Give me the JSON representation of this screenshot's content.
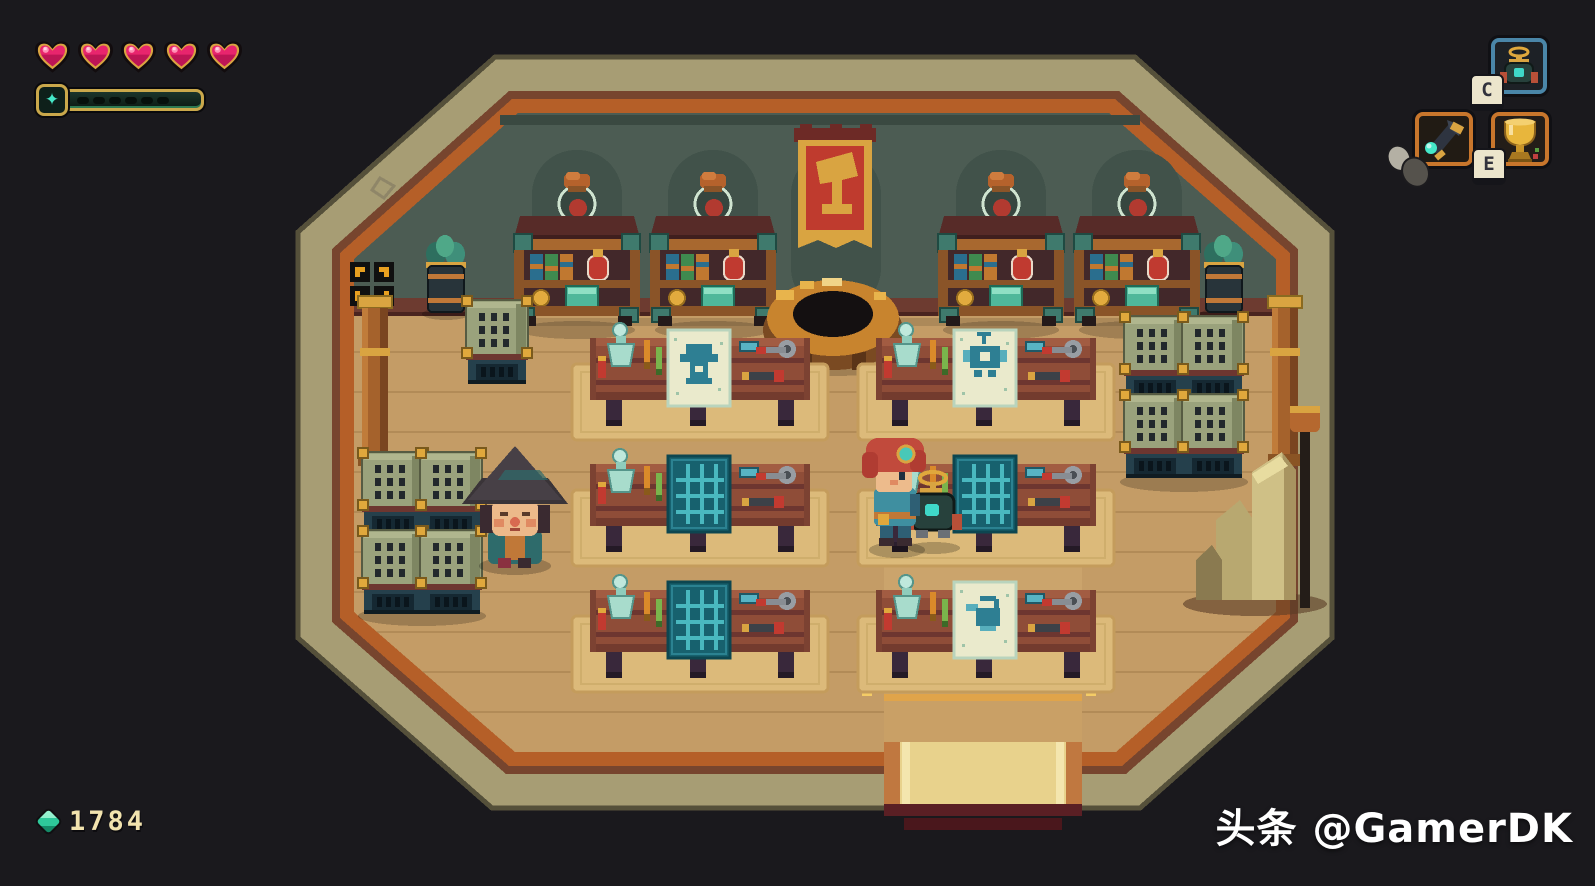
{
  "hud": {
    "hearts": {
      "count": 5,
      "filled": 5,
      "fill_color": "#e8256d",
      "border_color": "#d9a441",
      "outline_color": "#120c0e"
    },
    "energy": {
      "glyph": "✦",
      "segments": 6,
      "filled": 0,
      "frame_color": "#caa84b",
      "star_color": "#45e8c8"
    },
    "currency": {
      "amount": "1784",
      "gem_color": "#2ec89a",
      "text_color": "#f2e3ae"
    },
    "slots": {
      "gadget": {
        "item": "beacon-robot-gadget",
        "border_color": "#4a86a8",
        "keycap": "C"
      },
      "tool": {
        "item": "patcher-wrench-tool",
        "border_color": "#c8762c",
        "binding": "mouse"
      },
      "consumable": {
        "item": "gold-trophy",
        "border_color": "#c8762c",
        "keycap": "E"
      }
    }
  },
  "scene": {
    "location": "workshop-shop-interior",
    "banner_symbol": "gold hammer on red banner",
    "shelf_units": 4,
    "workbench_tables": 6,
    "blueprints": [
      "gadget-sketch",
      "robot-sketch",
      "empty-grid",
      "empty-grid",
      "empty-grid",
      "watering-can-sketch"
    ],
    "characters": [
      "shopkeeper-with-wide-hat",
      "player-red-hair"
    ],
    "center_fixture": "round wooden forge ring",
    "floor_color": "#c49c66",
    "wall_color": "#4c5c53",
    "trim_colors": {
      "band": "#a79d74",
      "maroon": "#77452e",
      "beam": "#b55f28"
    }
  },
  "watermark": {
    "text": "头条 @GamerDK"
  }
}
